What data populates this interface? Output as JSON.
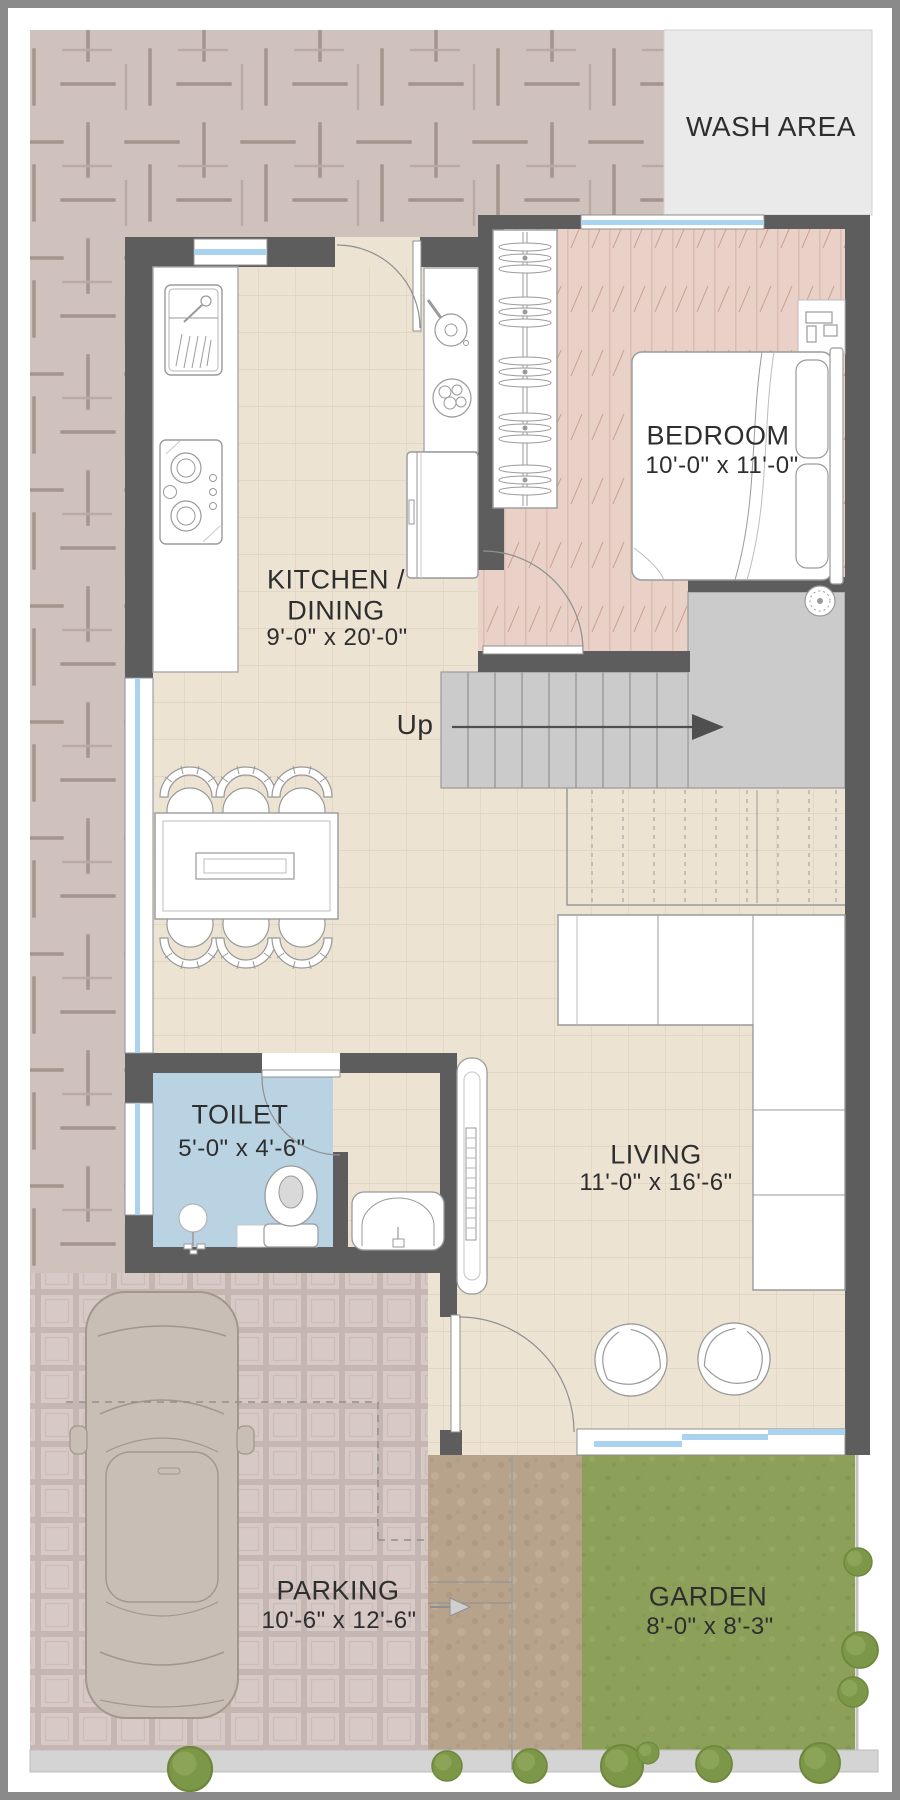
{
  "plan": {
    "rooms": {
      "wash_area": {
        "label": "WASH AREA",
        "dims": ""
      },
      "bedroom": {
        "label": "BEDROOM",
        "dims": "10'-0\" x 11'-0\""
      },
      "kitchen": {
        "label_line1": "KITCHEN /",
        "label_line2": "DINING",
        "dims": "9'-0\" x 20'-0\""
      },
      "toilet": {
        "label": "TOILET",
        "dims": "5'-0\" x 4'-6\""
      },
      "living": {
        "label": "LIVING",
        "dims": "11'-0\" x 16'-6\""
      },
      "parking": {
        "label": "PARKING",
        "dims": "10'-6\" x 12'-6\""
      },
      "garden": {
        "label": "GARDEN",
        "dims": "8'-0\" x 8'-3\""
      }
    },
    "stairs": {
      "direction_label": "Up"
    },
    "colors": {
      "wall": "#5d5d5d",
      "floor_tile": "#ece3d3",
      "bedroom_floor": "#e9d1c7",
      "toilet_floor": "#bad3e2",
      "wash_area": "#eaeaea",
      "stairs": "#cbcbcb",
      "garden": "#8da05a",
      "path": "#b7a28b",
      "parking_tile": "#d7cac6",
      "surround_pattern": "#cfc2bd",
      "window_glass": "#a9d3ef",
      "frame": "#8a8a8a"
    }
  }
}
